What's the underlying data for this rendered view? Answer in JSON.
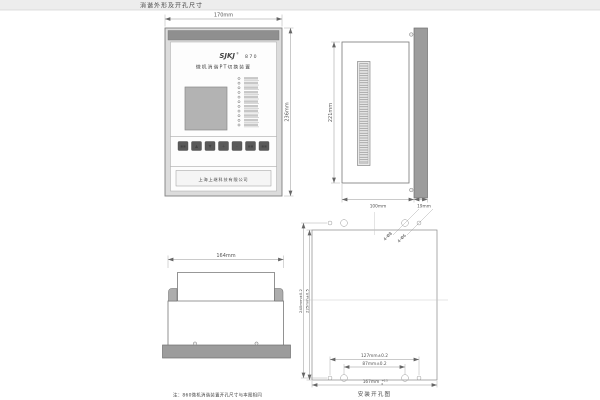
{
  "page": {
    "title": "消谐外形及开孔尺寸"
  },
  "front_view": {
    "dim_width": "170mm",
    "dim_height": "236mm",
    "logo": "SJKJ",
    "logo_reg": "®",
    "model": "870",
    "product_name": "微机消谐PT切换装置",
    "company": "上海上继科技有限公司",
    "buttons": [
      "▪▪",
      "▲",
      "▼",
      "+",
      "-",
      "▪▪",
      "▪▪"
    ]
  },
  "side_view": {
    "dim_height": "221mm",
    "dim_depth": "100mm",
    "dim_panel": "19mm"
  },
  "top_view": {
    "dim_width": "164mm"
  },
  "mount_view": {
    "dim_v_outer": "240mm±0.2",
    "dim_v_inner": "225mm±0.5",
    "dim_holes_outer": "127mm±0.2",
    "dim_holes_inner": "87mm±0.2",
    "dim_width": "167mm",
    "dim_width_tol_sup": "+0.5",
    "dim_width_tol_sub": "0",
    "callout_large_holes": "4-Φ8",
    "callout_small_holes": "4-Φ6",
    "caption": "安装开孔图"
  },
  "note": "注：860微机消谐装置开孔尺寸与本图相同",
  "colors": {
    "panel_gray": "#9c9c9c",
    "bezel_band": "#8f8f8f",
    "lcd_gray": "#b3b3b3",
    "button_gray": "#5a5a5a",
    "line_gray": "#777777"
  }
}
